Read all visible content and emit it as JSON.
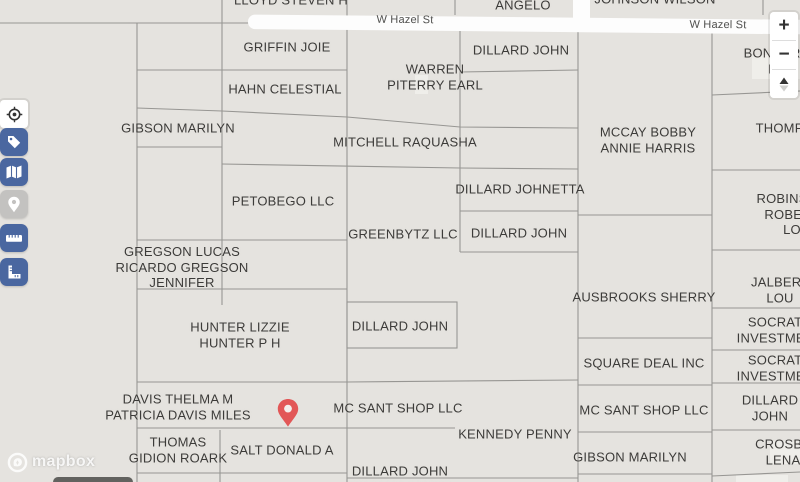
{
  "map": {
    "road": {
      "name": "W Hazel St",
      "label_positions": [
        {
          "x": 405,
          "y": 20
        },
        {
          "x": 718,
          "y": 25
        }
      ]
    },
    "parcel_labels": [
      {
        "text": "LLOYD STEVEN H",
        "x": 291,
        "y": 0
      },
      {
        "text": "ANGELO",
        "x": 523,
        "y": 5
      },
      {
        "text": "JOHNSON WILSON",
        "x": 655,
        "y": -1
      },
      {
        "text": "GRIFFIN JOIE",
        "x": 287,
        "y": 47
      },
      {
        "text": "DILLARD JOHN",
        "x": 521,
        "y": 50
      },
      {
        "text": "BONNER L",
        "x": 772,
        "y": 61
      },
      {
        "text": "WARREN\nPITERRY EARL",
        "x": 435,
        "y": 77
      },
      {
        "text": "HAHN CELESTIAL",
        "x": 285,
        "y": 89
      },
      {
        "text": "GIBSON MARILYN",
        "x": 178,
        "y": 128
      },
      {
        "text": "MCCAY BOBBY\nANNIE HARRIS",
        "x": 648,
        "y": 140
      },
      {
        "text": "THOMPSON",
        "x": 794,
        "y": 128
      },
      {
        "text": "MITCHELL RAQUASHA",
        "x": 405,
        "y": 142
      },
      {
        "text": "DILLARD JOHNETTA",
        "x": 520,
        "y": 189
      },
      {
        "text": "PETOBEGO LLC",
        "x": 283,
        "y": 201
      },
      {
        "text": "ROBINSON\nROBERT LO",
        "x": 792,
        "y": 214
      },
      {
        "text": "GREENBYTZ LLC",
        "x": 403,
        "y": 234
      },
      {
        "text": "DILLARD JOHN",
        "x": 519,
        "y": 233
      },
      {
        "text": "GREGSON LUCAS\nRICARDO GREGSON\nJENNIFER",
        "x": 182,
        "y": 267
      },
      {
        "text": "AUSBROOKS SHERRY",
        "x": 644,
        "y": 297
      },
      {
        "text": "JALBERT LOU",
        "x": 780,
        "y": 290
      },
      {
        "text": "HUNTER LIZZIE\nHUNTER P H",
        "x": 240,
        "y": 335
      },
      {
        "text": "DILLARD JOHN",
        "x": 400,
        "y": 326
      },
      {
        "text": "SOCRATES\nINVESTMENTS",
        "x": 784,
        "y": 330
      },
      {
        "text": "SQUARE DEAL INC",
        "x": 644,
        "y": 363
      },
      {
        "text": "SOCRATES\nINVESTMENTS",
        "x": 784,
        "y": 368
      },
      {
        "text": "DAVIS THELMA M\nPATRICIA DAVIS MILES",
        "x": 178,
        "y": 407
      },
      {
        "text": "MC SANT SHOP LLC",
        "x": 398,
        "y": 408
      },
      {
        "text": "MC SANT SHOP LLC",
        "x": 644,
        "y": 410
      },
      {
        "text": "DILLARD JOHN",
        "x": 770,
        "y": 408
      },
      {
        "text": "KENNEDY PENNY",
        "x": 515,
        "y": 434
      },
      {
        "text": "THOMAS\nGIDION ROARK",
        "x": 178,
        "y": 450
      },
      {
        "text": "SALT DONALD A",
        "x": 282,
        "y": 450
      },
      {
        "text": "GIBSON MARILYN",
        "x": 630,
        "y": 457
      },
      {
        "text": "CROSBY LENA",
        "x": 783,
        "y": 452
      },
      {
        "text": "DILLARD JOHN\nWILLIAM JAMES",
        "x": 400,
        "y": 479
      }
    ],
    "marker": {
      "x": 288,
      "y": 414,
      "color": "#e25757"
    }
  },
  "controls": {
    "zoom_in_label": "+",
    "zoom_out_label": "−",
    "icons": {
      "zoom_in": "plus-icon",
      "zoom_out": "minus-icon",
      "pitch": "pitch-triangles-icon",
      "locate": "geolocate-icon",
      "tags": "tag-icon",
      "layers": "folded-map-icon",
      "pin": "location-pin-icon",
      "measure": "ruler-icon",
      "area": "set-square-icon"
    }
  },
  "attribution": {
    "brand": "mapbox"
  },
  "colors": {
    "map_bg": "#e5e3df",
    "parcel_line": "#8f8e8b",
    "label_text": "#3c3b39",
    "road_fill": "#fdfdfd",
    "accent_blue": "#4a67a0",
    "marker_red": "#e25757"
  }
}
